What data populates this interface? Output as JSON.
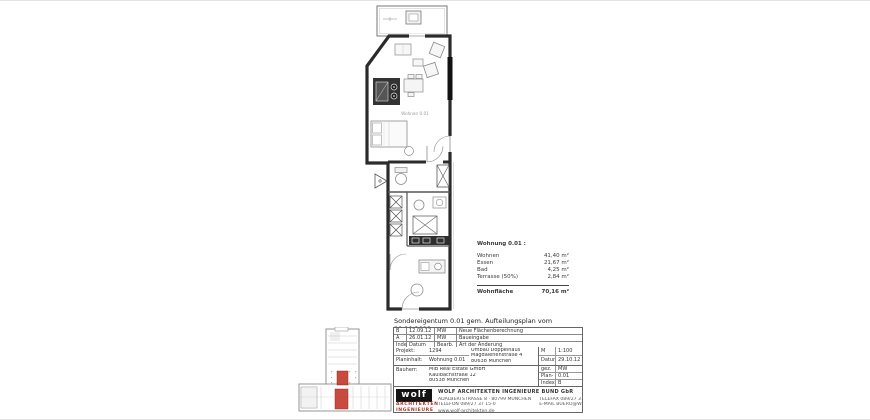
{
  "colors": {
    "wall": "#2b2b2b",
    "furniture_stroke": "#8c8c8c",
    "kitchen_block": "#333333",
    "accent_red": "#c0392b",
    "logo_bg": "#141414"
  },
  "floor_plan": {
    "room_label": "Wohnen 0.01"
  },
  "area_table": {
    "title": "Wohnung 0.01 :",
    "rows": [
      {
        "label": "Wohnen",
        "value": "41,40 m²"
      },
      {
        "label": "Essen",
        "value": "21,67 m²"
      },
      {
        "label": "Bad",
        "value": "4,25 m²"
      },
      {
        "label": "Terrasse (50%)",
        "value": "2,84 m²"
      }
    ],
    "total": {
      "label": "Wohnfläche",
      "value": "70,16 m²"
    }
  },
  "plan_title": "Sondereigentum 0.01 gem. Aufteilungsplan vom 29.10.2012",
  "revision_table": {
    "rows": [
      {
        "index": "B",
        "datum": "12.09.12",
        "bearb": "MW",
        "aenderung": "Neue Flächenberechnung"
      },
      {
        "index": "A",
        "datum": "26.01.12",
        "bearb": "MW",
        "aenderung": "Baueingabe"
      }
    ],
    "header": {
      "index": "Index",
      "datum": "Datum",
      "bearb": "Bearb.",
      "aenderung": "Art der Änderung"
    }
  },
  "title_block": {
    "projekt_label": "Projekt:",
    "projekt_nr": "1294",
    "planinhalt_label": "Planinhalt:",
    "planinhalt": "Wohnung 0.01",
    "adresse": [
      "Umbau Doppelhaus",
      "Magdalenenstraße 4",
      "80638 München"
    ],
    "bauherr_label": "Bauherr:",
    "bauherr": [
      "MIB Real Estate GmbH",
      "Kaulbachstraße 12",
      "80538 München"
    ],
    "fields_top": [
      {
        "label": "M",
        "value": "1:100"
      },
      {
        "label": "Datum",
        "value": "29.10.12"
      }
    ],
    "fields_bottom": [
      {
        "label": "gez.",
        "value": "MW"
      },
      {
        "label": "Plan-Nr.",
        "value": "0.01"
      },
      {
        "label": "Index",
        "value": "B"
      }
    ]
  },
  "logo": {
    "word": "wolf",
    "sub1": "ARCHITEKTEN",
    "sub2": "INGENIEURE",
    "firm": "WOLF ARCHITEKTEN INGENIEURE BUND GbR",
    "contact_left": [
      "ADALBERTSTRASSE 8 · 80799 MÜNCHEN",
      "TELEFON 089/27 37 15-0"
    ],
    "contact_right": [
      "TELEFAX 089/27 37 15-19",
      "E-MAIL BUERO@WOLF-ARCHITEKTEN.DE"
    ],
    "web": "www.wolf-architekten.de"
  }
}
